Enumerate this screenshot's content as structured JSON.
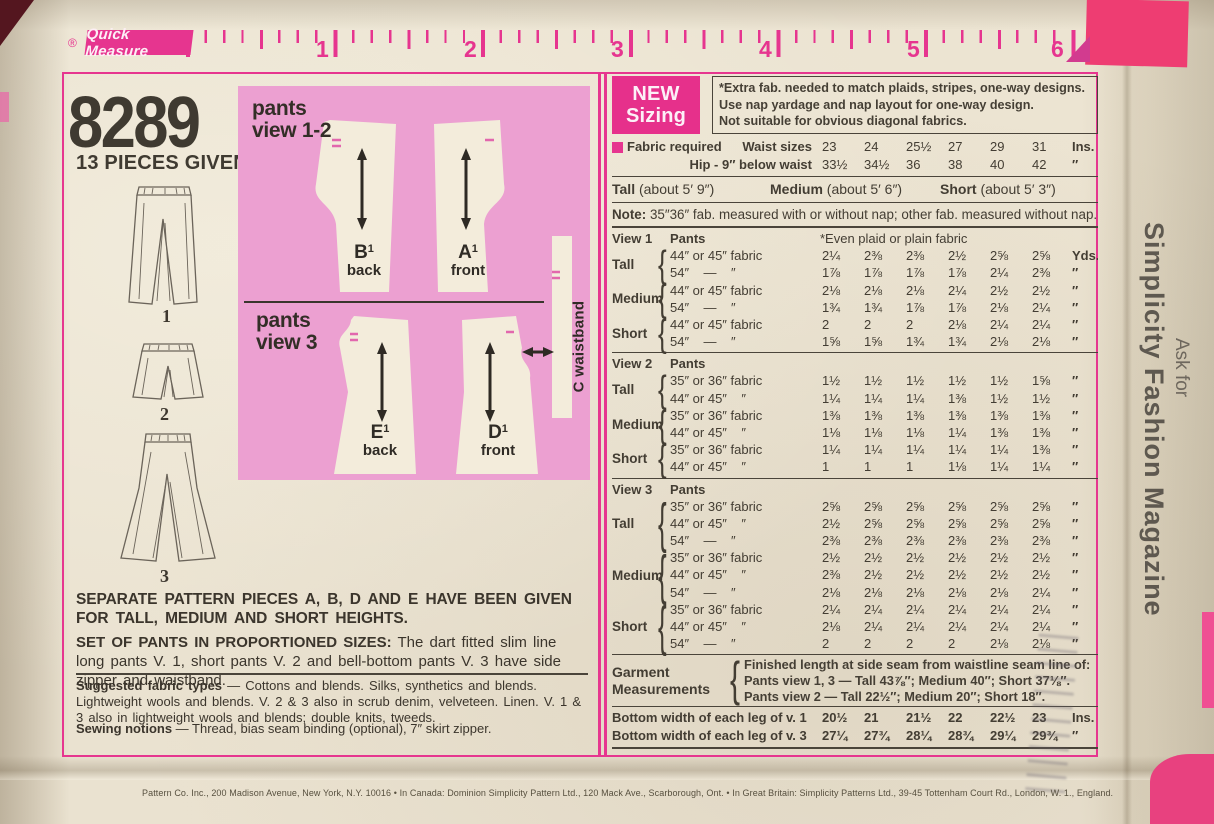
{
  "colors": {
    "accent_pink": "#e6358f",
    "diagram_pink": "#eca0d1",
    "paper": "#ece4d2",
    "ink": "#3e382f"
  },
  "ruler": {
    "reg_mark": "®",
    "brand": "Quick Measure",
    "numbers": [
      "1",
      "2",
      "3",
      "4",
      "5",
      "6"
    ]
  },
  "header": {
    "pattern_number": "8289",
    "pieces_given": "13 PIECES GIVEN"
  },
  "illustrations": {
    "view_labels": [
      "1",
      "2",
      "3"
    ]
  },
  "diagram": {
    "view12_label": "pants\nview 1-2",
    "view3_label": "pants\nview 3",
    "pieces": [
      {
        "letter": "B",
        "sup": "1",
        "part": "back"
      },
      {
        "letter": "A",
        "sup": "1",
        "part": "front"
      },
      {
        "letter": "E",
        "sup": "1",
        "part": "back"
      },
      {
        "letter": "D",
        "sup": "1",
        "part": "front"
      }
    ],
    "waistband_label": "C waistband"
  },
  "notes": {
    "separate_pieces": "SEPARATE PATTERN PIECES A, B, D AND E HAVE BEEN GIVEN FOR TALL, MEDIUM AND SHORT HEIGHTS.",
    "set_lead": "SET OF PANTS IN PROPORTIONED SIZES:",
    "set_rest": " The dart fitted slim line long pants V. 1, short pants V. 2 and bell-bottom pants V. 3 have side zipper and waistband.",
    "fabric_lead": "Suggested fabric types",
    "fabric_rest": " — Cottons and blends. Silks, synthetics and blends. Lightweight wools and blends. V. 2 & 3 also in scrub denim, velveteen. Linen. V. 1 & 3 also in lightweight wools and blends; double knits, tweeds.",
    "notions_lead": "Sewing notions",
    "notions_rest": " — Thread, bias seam binding (optional), 7″ skirt zipper."
  },
  "sizing": {
    "badge_line1": "NEW",
    "badge_line2": "Sizing",
    "extra_lines": [
      "*Extra fab. needed to match plaids, stripes, one-way designs.",
      "Use nap yardage and nap layout for one-way design.",
      "Not suitable for obvious diagonal fabrics."
    ],
    "fabric_required": "Fabric required",
    "waist": {
      "label": "Waist sizes",
      "values": [
        "23",
        "24",
        "25½",
        "27",
        "29",
        "31"
      ],
      "unit": "Ins."
    },
    "hip": {
      "label": "Hip - 9″ below waist",
      "values": [
        "33½",
        "34½",
        "36",
        "38",
        "40",
        "42"
      ],
      "unit": "″"
    },
    "heights": [
      {
        "name": "Tall",
        "desc": " (about 5′ 9″)"
      },
      {
        "name": "Medium",
        "desc": " (about 5′ 6″)"
      },
      {
        "name": "Short",
        "desc": " (about 5′ 3″)"
      }
    ],
    "note_lead": "Note:",
    "note_rest": " 35″36″ fab. measured with or without nap; other fab. measured without nap."
  },
  "yardage": {
    "views": [
      {
        "name": "View 1",
        "garment": "Pants",
        "extra": "*Even plaid or plain fabric",
        "groups": [
          {
            "height": "Tall",
            "rows": [
              {
                "fabric": "44″ or 45″ fabric",
                "v": [
                  "2¼",
                  "2⅜",
                  "2⅜",
                  "2½",
                  "2⅝",
                  "2⅝"
                ],
                "u": "Yds."
              },
              {
                "fabric": "54″    —    ″",
                "v": [
                  "1⅞",
                  "1⅞",
                  "1⅞",
                  "1⅞",
                  "2¼",
                  "2⅜"
                ],
                "u": "″"
              }
            ]
          },
          {
            "height": "Medium",
            "rows": [
              {
                "fabric": "44″ or 45″ fabric",
                "v": [
                  "2⅛",
                  "2⅛",
                  "2⅛",
                  "2¼",
                  "2½",
                  "2½"
                ],
                "u": "″"
              },
              {
                "fabric": "54″    —    ″",
                "v": [
                  "1¾",
                  "1¾",
                  "1⅞",
                  "1⅞",
                  "2⅛",
                  "2¼"
                ],
                "u": "″"
              }
            ]
          },
          {
            "height": "Short",
            "rows": [
              {
                "fabric": "44″ or 45″ fabric",
                "v": [
                  "2",
                  "2",
                  "2",
                  "2⅛",
                  "2¼",
                  "2¼"
                ],
                "u": "″"
              },
              {
                "fabric": "54″    —    ″",
                "v": [
                  "1⅝",
                  "1⅝",
                  "1¾",
                  "1¾",
                  "2⅛",
                  "2⅛"
                ],
                "u": "″"
              }
            ]
          }
        ]
      },
      {
        "name": "View 2",
        "garment": "Pants",
        "extra": "",
        "groups": [
          {
            "height": "Tall",
            "rows": [
              {
                "fabric": "35″ or 36″ fabric",
                "v": [
                  "1½",
                  "1½",
                  "1½",
                  "1½",
                  "1½",
                  "1⅝"
                ],
                "u": "″"
              },
              {
                "fabric": "44″ or 45″    ″",
                "v": [
                  "1¼",
                  "1¼",
                  "1¼",
                  "1⅜",
                  "1½",
                  "1½"
                ],
                "u": "″"
              }
            ]
          },
          {
            "height": "Medium",
            "rows": [
              {
                "fabric": "35″ or 36″ fabric",
                "v": [
                  "1⅜",
                  "1⅜",
                  "1⅜",
                  "1⅜",
                  "1⅜",
                  "1⅜"
                ],
                "u": "″"
              },
              {
                "fabric": "44″ or 45″    ″",
                "v": [
                  "1⅛",
                  "1⅛",
                  "1⅛",
                  "1¼",
                  "1⅜",
                  "1⅜"
                ],
                "u": "″"
              }
            ]
          },
          {
            "height": "Short",
            "rows": [
              {
                "fabric": "35″ or 36″ fabric",
                "v": [
                  "1¼",
                  "1¼",
                  "1¼",
                  "1¼",
                  "1¼",
                  "1⅜"
                ],
                "u": "″"
              },
              {
                "fabric": "44″ or 45″    ″",
                "v": [
                  "1",
                  "1",
                  "1",
                  "1⅛",
                  "1¼",
                  "1¼"
                ],
                "u": "″"
              }
            ]
          }
        ]
      },
      {
        "name": "View 3",
        "garment": "Pants",
        "extra": "",
        "groups": [
          {
            "height": "Tall",
            "rows": [
              {
                "fabric": "35″ or 36″ fabric",
                "v": [
                  "2⅝",
                  "2⅝",
                  "2⅝",
                  "2⅝",
                  "2⅝",
                  "2⅝"
                ],
                "u": "″"
              },
              {
                "fabric": "44″ or 45″    ″",
                "v": [
                  "2½",
                  "2⅝",
                  "2⅝",
                  "2⅝",
                  "2⅝",
                  "2⅝"
                ],
                "u": "″"
              },
              {
                "fabric": "54″    —    ″",
                "v": [
                  "2⅜",
                  "2⅜",
                  "2⅜",
                  "2⅜",
                  "2⅜",
                  "2⅜"
                ],
                "u": "″"
              }
            ]
          },
          {
            "height": "Medium",
            "rows": [
              {
                "fabric": "35″ or 36″ fabric",
                "v": [
                  "2½",
                  "2½",
                  "2½",
                  "2½",
                  "2½",
                  "2½"
                ],
                "u": "″"
              },
              {
                "fabric": "44″ or 45″    ″",
                "v": [
                  "2⅜",
                  "2½",
                  "2½",
                  "2½",
                  "2½",
                  "2½"
                ],
                "u": "″"
              },
              {
                "fabric": "54″    —    ″",
                "v": [
                  "2⅛",
                  "2⅛",
                  "2⅛",
                  "2⅛",
                  "2⅛",
                  "2¼"
                ],
                "u": "″"
              }
            ]
          },
          {
            "height": "Short",
            "rows": [
              {
                "fabric": "35″ or 36″ fabric",
                "v": [
                  "2¼",
                  "2¼",
                  "2¼",
                  "2¼",
                  "2¼",
                  "2¼"
                ],
                "u": "″"
              },
              {
                "fabric": "44″ or 45″    ″",
                "v": [
                  "2⅛",
                  "2¼",
                  "2¼",
                  "2¼",
                  "2¼",
                  "2¼"
                ],
                "u": "″"
              },
              {
                "fabric": "54″    —    ″",
                "v": [
                  "2",
                  "2",
                  "2",
                  "2",
                  "2⅛",
                  "2⅛"
                ],
                "u": "″"
              }
            ]
          }
        ]
      }
    ]
  },
  "garment_measurements": {
    "label_line1": "Garment",
    "label_line2": "Measurements",
    "lines": [
      "Finished length at side seam from waistline seam line of:",
      "Pants view 1, 3 — Tall 43⅞″; Medium 40″; Short 37⅛″.",
      "Pants view 2 — Tall 22½″; Medium 20″; Short 18″."
    ]
  },
  "bottom_widths": [
    {
      "label": "Bottom width of each leg of v. 1",
      "v": [
        "20½",
        "21",
        "21½",
        "22",
        "22½",
        "23"
      ],
      "u": "Ins."
    },
    {
      "label": "Bottom width of each leg of v. 3",
      "v": [
        "27¼",
        "27¾",
        "28¼",
        "28¾",
        "29¼",
        "29¾"
      ],
      "u": "″"
    }
  ],
  "side_text": {
    "ask_for": "Ask for",
    "magazine": "Simplicity Fashion Magazine"
  },
  "footer": "Pattern Co. Inc., 200 Madison Avenue, New York, N.Y. 10016   •   In Canada: Dominion Simplicity Pattern Ltd., 120 Mack Ave., Scarborough, Ont.   •   In Great Britain: Simplicity Patterns Ltd., 39-45 Tottenham Court Rd., London, W. 1., England."
}
